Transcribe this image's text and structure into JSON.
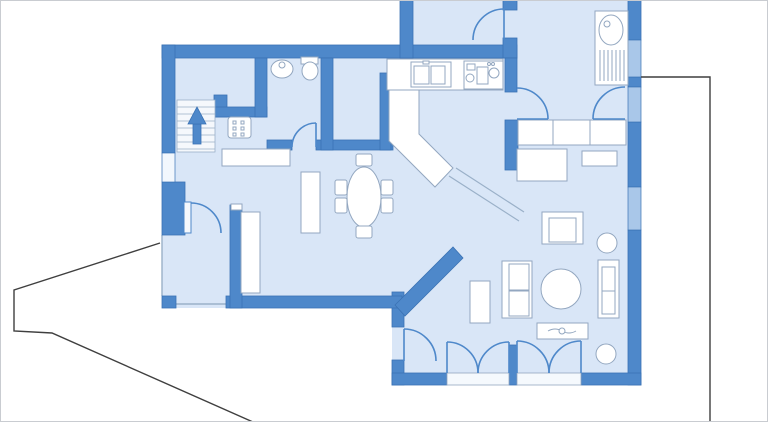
{
  "meta": {
    "title": "first-floor-plan",
    "canvas_w": 768,
    "canvas_h": 422
  },
  "palette": {
    "bg": "#ffffff",
    "frame": "#c9ccd1",
    "floor": "#d9e6f7",
    "wall": "#4e88ca",
    "wall_edge": "#3a72b4",
    "window_blue": "#a9c7e9",
    "window_white": "#f2f7fd",
    "furniture_fill": "#ffffff",
    "furniture_stroke": "#93a7c0",
    "door_stroke": "#4e88ca",
    "boundary": "#3f3f3f",
    "threshold_fill": "#f5f9fd",
    "divider_stroke": "#9ab0c8"
  },
  "footprint": [
    [
      162,
      48
    ],
    [
      408,
      48
    ],
    [
      408,
      0
    ],
    [
      641,
      0
    ],
    [
      641,
      385
    ],
    [
      392,
      385
    ],
    [
      392,
      308
    ],
    [
      162,
      308
    ]
  ],
  "terrace_edges": [
    {
      "name": "terrace-edge-left",
      "pts": [
        [
          162,
          235
        ],
        [
          162,
          296
        ]
      ]
    },
    {
      "name": "terrace-edge-bottom",
      "pts": [
        [
          176,
          304
        ],
        [
          230,
          304
        ]
      ]
    }
  ],
  "walls": [
    {
      "name": "top-wall",
      "r": [
        162,
        45,
        355,
        13
      ]
    },
    {
      "name": "vestibule-west-wall",
      "r": [
        400,
        0,
        13,
        58
      ]
    },
    {
      "name": "vestibule-east-wall-upper",
      "r": [
        503,
        0,
        14,
        10
      ]
    },
    {
      "name": "vestibule-east-wall-lower",
      "r": [
        503,
        38,
        14,
        20
      ]
    },
    {
      "name": "left-wall-upper",
      "r": [
        162,
        45,
        13,
        108
      ]
    },
    {
      "name": "left-wall-chunk",
      "r": [
        162,
        182,
        23,
        53
      ]
    },
    {
      "name": "terrace-post",
      "r": [
        162,
        296,
        14,
        12
      ]
    },
    {
      "name": "stair-stub-vertical",
      "r": [
        214,
        95,
        13,
        22
      ]
    },
    {
      "name": "stair-stub-horizontal",
      "r": [
        214,
        107,
        53,
        10
      ]
    },
    {
      "name": "wc-west-wall",
      "r": [
        255,
        58,
        12,
        59
      ]
    },
    {
      "name": "wc-bottom-wall-left",
      "r": [
        267,
        140,
        25,
        10
      ]
    },
    {
      "name": "wc-bottom-wall-right",
      "r": [
        316,
        140,
        77,
        10
      ]
    },
    {
      "name": "wc-pantry-divider",
      "r": [
        321,
        58,
        12,
        92
      ]
    },
    {
      "name": "pantry-kitchen-wall",
      "r": [
        380,
        73,
        11,
        77
      ]
    },
    {
      "name": "hall-west-wall-upper",
      "r": [
        505,
        58,
        12,
        34
      ]
    },
    {
      "name": "hall-west-wall-lower",
      "r": [
        505,
        120,
        13,
        50
      ]
    },
    {
      "name": "east-wall-1",
      "r": [
        628,
        0,
        13,
        40
      ]
    },
    {
      "name": "east-wall-2",
      "r": [
        628,
        77,
        13,
        10
      ]
    },
    {
      "name": "east-wall-3",
      "r": [
        628,
        122,
        13,
        65
      ]
    },
    {
      "name": "east-wall-4",
      "r": [
        628,
        230,
        13,
        155
      ]
    },
    {
      "name": "living-west-wall-upper",
      "r": [
        392,
        292,
        12,
        35
      ]
    },
    {
      "name": "living-west-wall-lower",
      "r": [
        392,
        360,
        12,
        25
      ]
    },
    {
      "name": "dining-bottom-wall",
      "r": [
        226,
        296,
        176,
        12
      ]
    },
    {
      "name": "dining-west-wall",
      "r": [
        230,
        205,
        12,
        103
      ]
    },
    {
      "name": "living-bottom-wall-left",
      "r": [
        392,
        373,
        55,
        12
      ]
    },
    {
      "name": "french-door-mullion",
      "r": [
        509,
        345,
        8,
        40
      ]
    },
    {
      "name": "living-bottom-wall-right",
      "r": [
        581,
        373,
        60,
        12
      ]
    }
  ],
  "diagonal_wall": {
    "name": "dining-living-diagonal-wall",
    "pts": [
      [
        395,
        305
      ],
      [
        453,
        247
      ],
      [
        463,
        258
      ],
      [
        405,
        316
      ]
    ]
  },
  "divider_lines": [
    {
      "name": "open-divider-line-1",
      "pts": [
        [
          449,
          176
        ],
        [
          519,
          221
        ]
      ]
    },
    {
      "name": "open-divider-line-2",
      "pts": [
        [
          456,
          168
        ],
        [
          524,
          212
        ]
      ]
    }
  ],
  "windows": [
    {
      "name": "window-left-wall",
      "r": [
        162,
        153,
        13,
        29
      ],
      "fill": "window_white"
    },
    {
      "name": "window-east-1",
      "r": [
        628,
        40,
        13,
        37
      ],
      "fill": "window_blue"
    },
    {
      "name": "window-east-2",
      "r": [
        628,
        87,
        13,
        35
      ],
      "fill": "window_blue"
    },
    {
      "name": "window-east-3",
      "r": [
        628,
        187,
        13,
        43
      ],
      "fill": "window_blue"
    }
  ],
  "thresholds": [
    {
      "name": "french-door-a-threshold",
      "r": [
        447,
        373,
        62,
        12
      ]
    },
    {
      "name": "french-door-b-threshold",
      "r": [
        517,
        373,
        64,
        12
      ]
    }
  ],
  "doors": [
    {
      "name": "vestibule-door",
      "arc": "M 504,9 A 31 31 0 0 0 473,40",
      "leaf": [
        504,
        9,
        504,
        40
      ]
    },
    {
      "name": "kitchen-hall-door",
      "arc": "M 548,119 A 31 31 0 0 0 517,88",
      "leaf": [
        517,
        119,
        548,
        119
      ]
    },
    {
      "name": "utility-hall-door",
      "arc": "M 593,119 A 32 32 0 0 1 625,87",
      "leaf": [
        593,
        119,
        625,
        119
      ]
    },
    {
      "name": "wc-door",
      "arc": "M 316,123 A 24 24 0 0 0 292,147",
      "leaf": [
        316,
        123,
        316,
        147
      ]
    },
    {
      "name": "terrace-door",
      "arc": "M 191,203 A 30 30 0 0 1 221,233",
      "leaf_rect": [
        184,
        202,
        7,
        31
      ]
    },
    {
      "name": "garden-side-door",
      "arc": "M 404,329 A 32 32 0 0 1 436,361",
      "leaf": [
        404,
        329,
        404,
        361
      ]
    },
    {
      "name": "french-door-a-left-leaf",
      "arc": "M 447,342 A 31 31 0 0 1 478,373",
      "leaf": [
        447,
        342,
        447,
        373
      ]
    },
    {
      "name": "french-door-a-right-leaf",
      "arc": "M 509,342 A 31 31 0 0 0 478,373",
      "leaf": [
        509,
        342,
        509,
        373
      ]
    },
    {
      "name": "french-door-b-left-leaf",
      "arc": "M 517,341 A 32 32 0 0 1 549,373",
      "leaf": [
        517,
        341,
        517,
        373
      ]
    },
    {
      "name": "french-door-b-right-leaf",
      "arc": "M 581,341 A 32 32 0 0 0 549,373",
      "leaf": [
        581,
        341,
        581,
        373
      ]
    }
  ],
  "stairs": {
    "name": "staircase-up",
    "box": [
      177,
      100,
      38,
      52
    ],
    "tread_ys": [
      107,
      114,
      121,
      128,
      135,
      142,
      149
    ],
    "arrow_head": [
      [
        188,
        124
      ],
      [
        206,
        124
      ],
      [
        197,
        107
      ]
    ],
    "arrow_shaft": [
      193,
      124,
      8,
      20
    ]
  },
  "furniture": [
    {
      "name": "hall-cabinet",
      "shapes": [
        {
          "t": "rect",
          "r": [
            228,
            117,
            23,
            21
          ],
          "rx": 3
        },
        {
          "t": "rect",
          "r": [
            233,
            121,
            3,
            3
          ]
        },
        {
          "t": "rect",
          "r": [
            241,
            121,
            3,
            3
          ]
        },
        {
          "t": "rect",
          "r": [
            233,
            127,
            3,
            3
          ]
        },
        {
          "t": "rect",
          "r": [
            241,
            127,
            3,
            3
          ]
        },
        {
          "t": "rect",
          "r": [
            233,
            133,
            3,
            3
          ]
        },
        {
          "t": "rect",
          "r": [
            241,
            133,
            3,
            3
          ]
        }
      ]
    },
    {
      "name": "wc-sink",
      "shapes": [
        {
          "t": "ellipse",
          "e": [
            282,
            69,
            11,
            9
          ]
        },
        {
          "t": "circle",
          "c": [
            282,
            65,
            3
          ]
        }
      ]
    },
    {
      "name": "wc-toilet",
      "shapes": [
        {
          "t": "rect",
          "r": [
            301,
            57,
            17,
            7
          ]
        },
        {
          "t": "ellipse",
          "e": [
            310,
            71,
            8,
            9
          ]
        }
      ]
    },
    {
      "name": "kitchen-counter",
      "shapes": [
        {
          "t": "rect",
          "r": [
            387,
            59,
            116,
            31
          ]
        }
      ]
    },
    {
      "name": "kitchen-sink",
      "shapes": [
        {
          "t": "rect",
          "r": [
            411,
            62,
            40,
            25
          ]
        },
        {
          "t": "rect",
          "r": [
            414,
            66,
            15,
            18
          ]
        },
        {
          "t": "rect",
          "r": [
            431,
            66,
            14,
            18
          ]
        },
        {
          "t": "rect",
          "r": [
            423,
            61,
            6,
            3
          ]
        }
      ]
    },
    {
      "name": "kitchen-stove",
      "shapes": [
        {
          "t": "rect",
          "r": [
            464,
            61,
            39,
            28
          ]
        },
        {
          "t": "rect",
          "r": [
            467,
            64,
            8,
            6
          ]
        },
        {
          "t": "rect",
          "r": [
            477,
            67,
            11,
            17
          ]
        },
        {
          "t": "circle",
          "c": [
            494,
            73,
            5
          ]
        },
        {
          "t": "circle",
          "c": [
            470,
            78,
            4
          ]
        },
        {
          "t": "circle",
          "c": [
            489,
            64,
            1.5
          ]
        },
        {
          "t": "circle",
          "c": [
            493,
            64,
            1.5
          ]
        }
      ]
    },
    {
      "name": "kitchen-peninsula",
      "shapes": [
        {
          "t": "polygon",
          "pts": [
            [
              389,
              90
            ],
            [
              419,
              90
            ],
            [
              419,
              134
            ],
            [
              453,
              168
            ],
            [
              435,
              187
            ],
            [
              389,
              141
            ]
          ]
        }
      ]
    },
    {
      "name": "utility-sink-unit",
      "shapes": [
        {
          "t": "rect",
          "r": [
            595,
            11,
            33,
            74
          ]
        },
        {
          "t": "ellipse",
          "e": [
            611,
            30,
            12,
            15
          ]
        },
        {
          "t": "circle",
          "c": [
            607,
            24,
            3
          ]
        },
        {
          "t": "line",
          "l": [
            600,
            50,
            600,
            81
          ]
        },
        {
          "t": "line",
          "l": [
            604,
            50,
            604,
            81
          ]
        },
        {
          "t": "line",
          "l": [
            608,
            50,
            608,
            81
          ]
        },
        {
          "t": "line",
          "l": [
            612,
            50,
            612,
            81
          ]
        },
        {
          "t": "line",
          "l": [
            616,
            50,
            616,
            81
          ]
        },
        {
          "t": "line",
          "l": [
            620,
            50,
            620,
            81
          ]
        },
        {
          "t": "line",
          "l": [
            624,
            50,
            624,
            81
          ]
        }
      ]
    },
    {
      "name": "hall-wardrobe",
      "shapes": [
        {
          "t": "rect",
          "r": [
            518,
            120,
            108,
            25
          ]
        },
        {
          "t": "line",
          "l": [
            553,
            120,
            553,
            145
          ]
        },
        {
          "t": "line",
          "l": [
            590,
            120,
            590,
            145
          ]
        }
      ]
    },
    {
      "name": "dining-sideboard",
      "shapes": [
        {
          "t": "rect",
          "r": [
            222,
            149,
            68,
            17
          ]
        }
      ]
    },
    {
      "name": "tall-sideboard",
      "shapes": [
        {
          "t": "rect",
          "r": [
            301,
            172,
            19,
            61
          ]
        }
      ]
    },
    {
      "name": "bedroom-wardrobe",
      "shapes": [
        {
          "t": "rect",
          "r": [
            241,
            212,
            19,
            81
          ]
        }
      ]
    },
    {
      "name": "wall-end-cap",
      "shapes": [
        {
          "t": "rect",
          "r": [
            231,
            204,
            11,
            6
          ]
        }
      ]
    },
    {
      "name": "dining-table",
      "shapes": [
        {
          "t": "ellipse",
          "e": [
            364,
            197,
            17,
            30
          ]
        }
      ]
    },
    {
      "name": "dining-chair-top",
      "shapes": [
        {
          "t": "rect",
          "r": [
            356,
            154,
            16,
            12
          ],
          "rx": 2
        }
      ]
    },
    {
      "name": "dining-chair-bottom",
      "shapes": [
        {
          "t": "rect",
          "r": [
            356,
            226,
            16,
            12
          ],
          "rx": 2
        }
      ]
    },
    {
      "name": "dining-chair-left-1",
      "shapes": [
        {
          "t": "rect",
          "r": [
            335,
            180,
            12,
            15
          ],
          "rx": 2
        }
      ]
    },
    {
      "name": "dining-chair-left-2",
      "shapes": [
        {
          "t": "rect",
          "r": [
            335,
            198,
            12,
            15
          ],
          "rx": 2
        }
      ]
    },
    {
      "name": "dining-chair-right-1",
      "shapes": [
        {
          "t": "rect",
          "r": [
            381,
            180,
            12,
            15
          ],
          "rx": 2
        }
      ]
    },
    {
      "name": "dining-chair-right-2",
      "shapes": [
        {
          "t": "rect",
          "r": [
            381,
            198,
            12,
            15
          ],
          "rx": 2
        }
      ]
    },
    {
      "name": "living-desk",
      "shapes": [
        {
          "t": "rect",
          "r": [
            517,
            149,
            50,
            32
          ]
        }
      ]
    },
    {
      "name": "living-shelf",
      "shapes": [
        {
          "t": "rect",
          "r": [
            582,
            151,
            35,
            15
          ]
        }
      ]
    },
    {
      "name": "armchair",
      "shapes": [
        {
          "t": "rect",
          "r": [
            542,
            212,
            41,
            32
          ]
        },
        {
          "t": "rect",
          "r": [
            549,
            218,
            27,
            24
          ]
        }
      ]
    },
    {
      "name": "plant-1",
      "shapes": [
        {
          "t": "circle",
          "c": [
            607,
            243,
            10
          ]
        }
      ]
    },
    {
      "name": "sofa-left",
      "shapes": [
        {
          "t": "rect",
          "r": [
            502,
            261,
            30,
            57
          ]
        },
        {
          "t": "rect",
          "r": [
            509,
            264,
            20,
            26
          ]
        },
        {
          "t": "rect",
          "r": [
            509,
            291,
            20,
            25
          ]
        }
      ]
    },
    {
      "name": "sofa-right",
      "shapes": [
        {
          "t": "rect",
          "r": [
            598,
            260,
            21,
            58
          ]
        },
        {
          "t": "rect",
          "r": [
            602,
            267,
            13,
            47
          ]
        },
        {
          "t": "line",
          "l": [
            602,
            291,
            615,
            291
          ]
        }
      ]
    },
    {
      "name": "coffee-table",
      "shapes": [
        {
          "t": "circle",
          "c": [
            561,
            289,
            20
          ]
        }
      ]
    },
    {
      "name": "bookshelf",
      "shapes": [
        {
          "t": "rect",
          "r": [
            470,
            281,
            20,
            42
          ]
        }
      ]
    },
    {
      "name": "tv-lowboard",
      "shapes": [
        {
          "t": "rect",
          "r": [
            537,
            323,
            51,
            16
          ]
        },
        {
          "t": "path",
          "d": "M 548,331 q 7,-4 14,0 q 7,4 14,0"
        },
        {
          "t": "circle",
          "c": [
            562,
            331,
            3
          ]
        }
      ]
    },
    {
      "name": "plant-2",
      "shapes": [
        {
          "t": "circle",
          "c": [
            606,
            354,
            10
          ]
        }
      ]
    }
  ],
  "boundary_lines": [
    {
      "name": "property-line-left",
      "pts": [
        [
          160,
          243
        ],
        [
          14,
          290
        ],
        [
          14,
          331
        ],
        [
          52,
          333
        ],
        [
          253,
          422
        ]
      ]
    },
    {
      "name": "terrace-outline-right",
      "pts": [
        [
          641,
          77
        ],
        [
          710,
          77
        ],
        [
          710,
          422
        ]
      ]
    }
  ]
}
